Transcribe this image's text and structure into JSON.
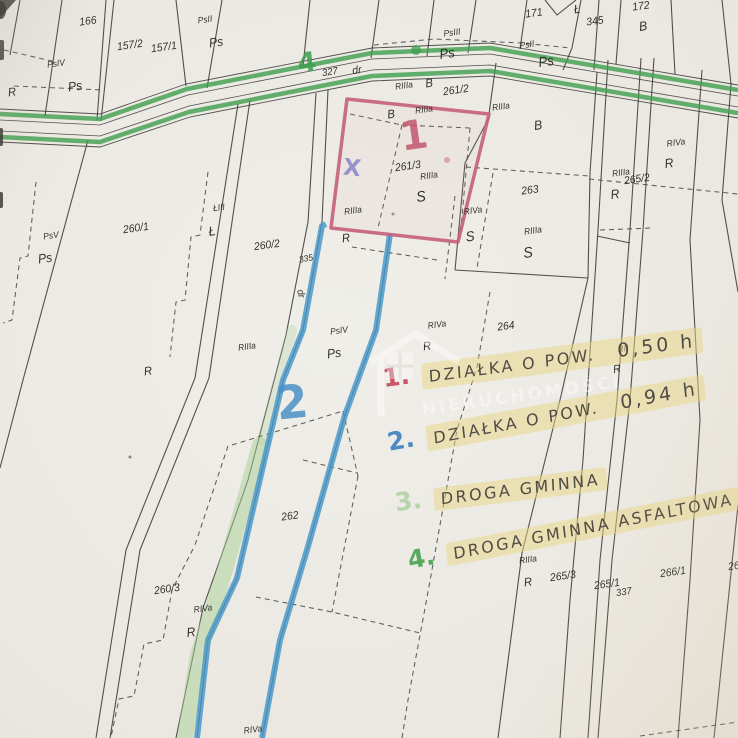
{
  "colors": {
    "paper": "#eae8e2",
    "line": "#3c3a36",
    "green_road": "#3f9e4d",
    "green_faded": "#a8cf96",
    "blue": "#4596c8",
    "red": "#c4607a",
    "red_marker": "#c1495c",
    "blue_marker": "#3c7fc0",
    "green_marker": "#47a34f",
    "green_marker_faded": "#a6cc96",
    "violet_marker": "#8b85c8",
    "pencil": "#4f4c46",
    "highlight": "#e9d682"
  },
  "legend": {
    "items": [
      {
        "number": "1.",
        "label": "DZIAŁKA O POW.",
        "value": "0,50 h",
        "color": "#c1495c"
      },
      {
        "number": "2.",
        "label": "DZIAŁKA O POW.",
        "value": "0,94 h",
        "color": "#3c7fc0"
      },
      {
        "number": "3.",
        "label": "DROGA GMINNA",
        "value": "",
        "color": "#a6cc96"
      },
      {
        "number": "4.",
        "label": "DROGA GMINNA ASFALTOWA",
        "value": "",
        "color": "#47a34f"
      }
    ]
  },
  "watermark": {
    "text": "NIERUCHOMOŚCI"
  },
  "map": {
    "markers": [
      {
        "t": "4",
        "x": 307,
        "y": 63,
        "s": 27,
        "color": "#3f9e4d",
        "r": -6
      },
      {
        "t": "1",
        "x": 414,
        "y": 136,
        "s": 40,
        "color": "#c4566e",
        "r": -8
      },
      {
        "t": "X",
        "x": 352,
        "y": 169,
        "s": 23,
        "color": "#8b85c8",
        "r": 6
      },
      {
        "t": "2",
        "x": 292,
        "y": 402,
        "s": 46,
        "color": "#4a90c8",
        "r": -6
      }
    ],
    "labels": [
      {
        "t": "166",
        "x": 88,
        "y": 22,
        "s": 11,
        "r": -8
      },
      {
        "t": "157/2",
        "x": 130,
        "y": 46,
        "s": 11,
        "r": -8
      },
      {
        "t": "157/1",
        "x": 164,
        "y": 48,
        "s": 11,
        "r": -8
      },
      {
        "t": "PsII",
        "x": 205,
        "y": 20,
        "s": 9,
        "r": -8
      },
      {
        "t": "Ps",
        "x": 216,
        "y": 42,
        "s": 13,
        "r": -8
      },
      {
        "t": "PsIV",
        "x": 56,
        "y": 64,
        "s": 9,
        "r": -8
      },
      {
        "t": "Ps",
        "x": 75,
        "y": 86,
        "s": 13,
        "r": -8
      },
      {
        "t": "R",
        "x": 12,
        "y": 92,
        "s": 12,
        "r": -8
      },
      {
        "t": "327",
        "x": 330,
        "y": 73,
        "s": 10,
        "r": -8
      },
      {
        "t": "dr",
        "x": 357,
        "y": 71,
        "s": 11,
        "r": -8
      },
      {
        "t": "171",
        "x": 534,
        "y": 14,
        "s": 11,
        "r": -8
      },
      {
        "t": "Ł",
        "x": 577,
        "y": 9,
        "s": 12,
        "r": -8
      },
      {
        "t": "345",
        "x": 595,
        "y": 22,
        "s": 11,
        "r": -8
      },
      {
        "t": "172",
        "x": 641,
        "y": 7,
        "s": 11,
        "r": -8
      },
      {
        "t": "B",
        "x": 643,
        "y": 26,
        "s": 13,
        "r": -8
      },
      {
        "t": "PsIII",
        "x": 452,
        "y": 33,
        "s": 9,
        "r": -8
      },
      {
        "t": "Ps",
        "x": 447,
        "y": 53,
        "s": 14,
        "r": -8
      },
      {
        "t": "PsII",
        "x": 527,
        "y": 45,
        "s": 9,
        "r": -8
      },
      {
        "t": "Ps",
        "x": 546,
        "y": 61,
        "s": 14,
        "r": -8
      },
      {
        "t": "RIIIa",
        "x": 404,
        "y": 86,
        "s": 9,
        "r": -8
      },
      {
        "t": "B",
        "x": 429,
        "y": 83,
        "s": 12,
        "r": -8
      },
      {
        "t": "261/2",
        "x": 456,
        "y": 91,
        "s": 11,
        "r": -8
      },
      {
        "t": "B",
        "x": 391,
        "y": 114,
        "s": 12,
        "r": -8
      },
      {
        "t": "RIIIa",
        "x": 424,
        "y": 110,
        "s": 9,
        "r": -8
      },
      {
        "t": "RIIIa",
        "x": 501,
        "y": 107,
        "s": 9,
        "r": -8
      },
      {
        "t": "B",
        "x": 538,
        "y": 125,
        "s": 13,
        "r": -8
      },
      {
        "t": "261/3",
        "x": 408,
        "y": 167,
        "s": 11,
        "r": -8
      },
      {
        "t": "RIIIa",
        "x": 429,
        "y": 176,
        "s": 9,
        "r": -8
      },
      {
        "t": "S",
        "x": 421,
        "y": 197,
        "s": 15,
        "r": -8
      },
      {
        "t": "RIIIa",
        "x": 353,
        "y": 211,
        "s": 9,
        "r": -8
      },
      {
        "t": "R",
        "x": 346,
        "y": 238,
        "s": 12,
        "r": -8
      },
      {
        "t": "RIVa",
        "x": 473,
        "y": 211,
        "s": 9,
        "r": -8
      },
      {
        "t": "S",
        "x": 470,
        "y": 236,
        "s": 14,
        "r": -8
      },
      {
        "t": "263",
        "x": 530,
        "y": 191,
        "s": 11,
        "r": -8
      },
      {
        "t": "RIIIa",
        "x": 533,
        "y": 231,
        "s": 9,
        "r": -8
      },
      {
        "t": "S",
        "x": 528,
        "y": 253,
        "s": 15,
        "r": -8
      },
      {
        "t": "RIVa",
        "x": 676,
        "y": 143,
        "s": 9,
        "r": -8
      },
      {
        "t": "R",
        "x": 669,
        "y": 163,
        "s": 13,
        "r": -8
      },
      {
        "t": "RIIIa",
        "x": 621,
        "y": 173,
        "s": 9,
        "r": -8
      },
      {
        "t": "265/2",
        "x": 637,
        "y": 180,
        "s": 11,
        "r": -8
      },
      {
        "t": "R",
        "x": 615,
        "y": 194,
        "s": 13,
        "r": -8
      },
      {
        "t": "260/1",
        "x": 136,
        "y": 229,
        "s": 11,
        "r": -8
      },
      {
        "t": "ŁIII",
        "x": 219,
        "y": 208,
        "s": 9,
        "r": -8
      },
      {
        "t": "Ł",
        "x": 212,
        "y": 231,
        "s": 13,
        "r": -8
      },
      {
        "t": "260/2",
        "x": 267,
        "y": 246,
        "s": 11,
        "r": -8
      },
      {
        "t": "335",
        "x": 306,
        "y": 259,
        "s": 9,
        "r": -12
      },
      {
        "t": "dr",
        "x": 300,
        "y": 294,
        "s": 10,
        "r": 78
      },
      {
        "t": "PsV",
        "x": 51,
        "y": 236,
        "s": 9,
        "r": -8
      },
      {
        "t": "Ps",
        "x": 45,
        "y": 258,
        "s": 13,
        "r": -8
      },
      {
        "t": "R",
        "x": 148,
        "y": 371,
        "s": 12,
        "r": -8
      },
      {
        "t": "RIIIa",
        "x": 247,
        "y": 347,
        "s": 9,
        "r": -8
      },
      {
        "t": "PsIV",
        "x": 339,
        "y": 331,
        "s": 9,
        "r": -8
      },
      {
        "t": "Ps",
        "x": 334,
        "y": 353,
        "s": 13,
        "r": -8
      },
      {
        "t": "RIVa",
        "x": 437,
        "y": 325,
        "s": 9,
        "r": -8
      },
      {
        "t": "R",
        "x": 427,
        "y": 346,
        "s": 12,
        "r": -8
      },
      {
        "t": "264",
        "x": 506,
        "y": 327,
        "s": 11,
        "r": -8
      },
      {
        "t": "RII",
        "x": 623,
        "y": 349,
        "s": 9,
        "r": -8
      },
      {
        "t": "R",
        "x": 617,
        "y": 370,
        "s": 11,
        "r": -8
      },
      {
        "t": "262",
        "x": 290,
        "y": 517,
        "s": 11,
        "r": -8
      },
      {
        "t": "260/3",
        "x": 167,
        "y": 590,
        "s": 11,
        "r": -8
      },
      {
        "t": "RIVa",
        "x": 203,
        "y": 609,
        "s": 9,
        "r": -8
      },
      {
        "t": "R",
        "x": 191,
        "y": 632,
        "s": 13,
        "r": -8
      },
      {
        "t": "RIVa",
        "x": 253,
        "y": 730,
        "s": 9,
        "r": -8
      },
      {
        "t": "RIIIa",
        "x": 528,
        "y": 560,
        "s": 9,
        "r": -8
      },
      {
        "t": "R",
        "x": 528,
        "y": 582,
        "s": 12,
        "r": -8
      },
      {
        "t": "265/3",
        "x": 563,
        "y": 577,
        "s": 11,
        "r": -8
      },
      {
        "t": "265/1",
        "x": 607,
        "y": 585,
        "s": 11,
        "r": -8
      },
      {
        "t": "337",
        "x": 624,
        "y": 593,
        "s": 10,
        "r": -8
      },
      {
        "t": "266/1",
        "x": 673,
        "y": 573,
        "s": 11,
        "r": -8
      },
      {
        "t": "26",
        "x": 734,
        "y": 567,
        "s": 11,
        "r": -8
      }
    ]
  }
}
